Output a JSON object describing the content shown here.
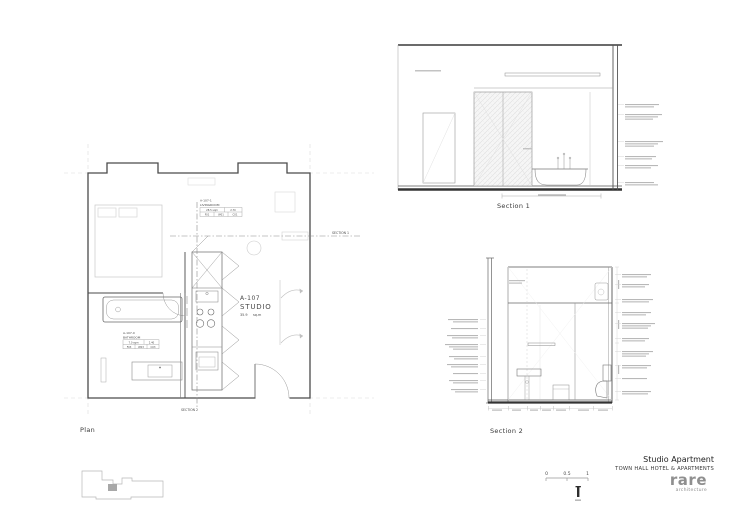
{
  "plan": {
    "label": "Plan",
    "unit_tag": {
      "code": "A-107",
      "name": "STUDIO",
      "area": "35.9",
      "area_unit": "sq.m"
    },
    "room_tags": [
      {
        "code": "A-107-1",
        "name": "LIVINGROOM",
        "metrics": [
          "28.5 sqm",
          "2.70"
        ],
        "finishes": [
          "F01",
          "W01",
          "C01"
        ]
      },
      {
        "code": "A-107-0",
        "name": "BATHROOM",
        "metrics": [
          "7.0 sqm",
          "2.40"
        ],
        "finishes": [
          "F03",
          "W03",
          "C03"
        ]
      }
    ],
    "section_markers": [
      {
        "label": "SECTION 1"
      },
      {
        "label": "SECTION 2"
      }
    ]
  },
  "sections": [
    {
      "label": "Section 1"
    },
    {
      "label": "Section 2"
    }
  ],
  "scalebar": {
    "labels": [
      "0",
      "0.5",
      "1"
    ]
  },
  "titleblock": {
    "title": "Studio Apartment",
    "subtitle": "TOWN HALL HOTEL & APARTMENTS"
  },
  "logo": {
    "word": "rare",
    "sub": "architecture"
  },
  "colors": {
    "wall_line": "#4a4a4a",
    "light_line": "#b8b8b8",
    "text": "#3a3a3a",
    "logo_gray": "#8f8f8f"
  }
}
